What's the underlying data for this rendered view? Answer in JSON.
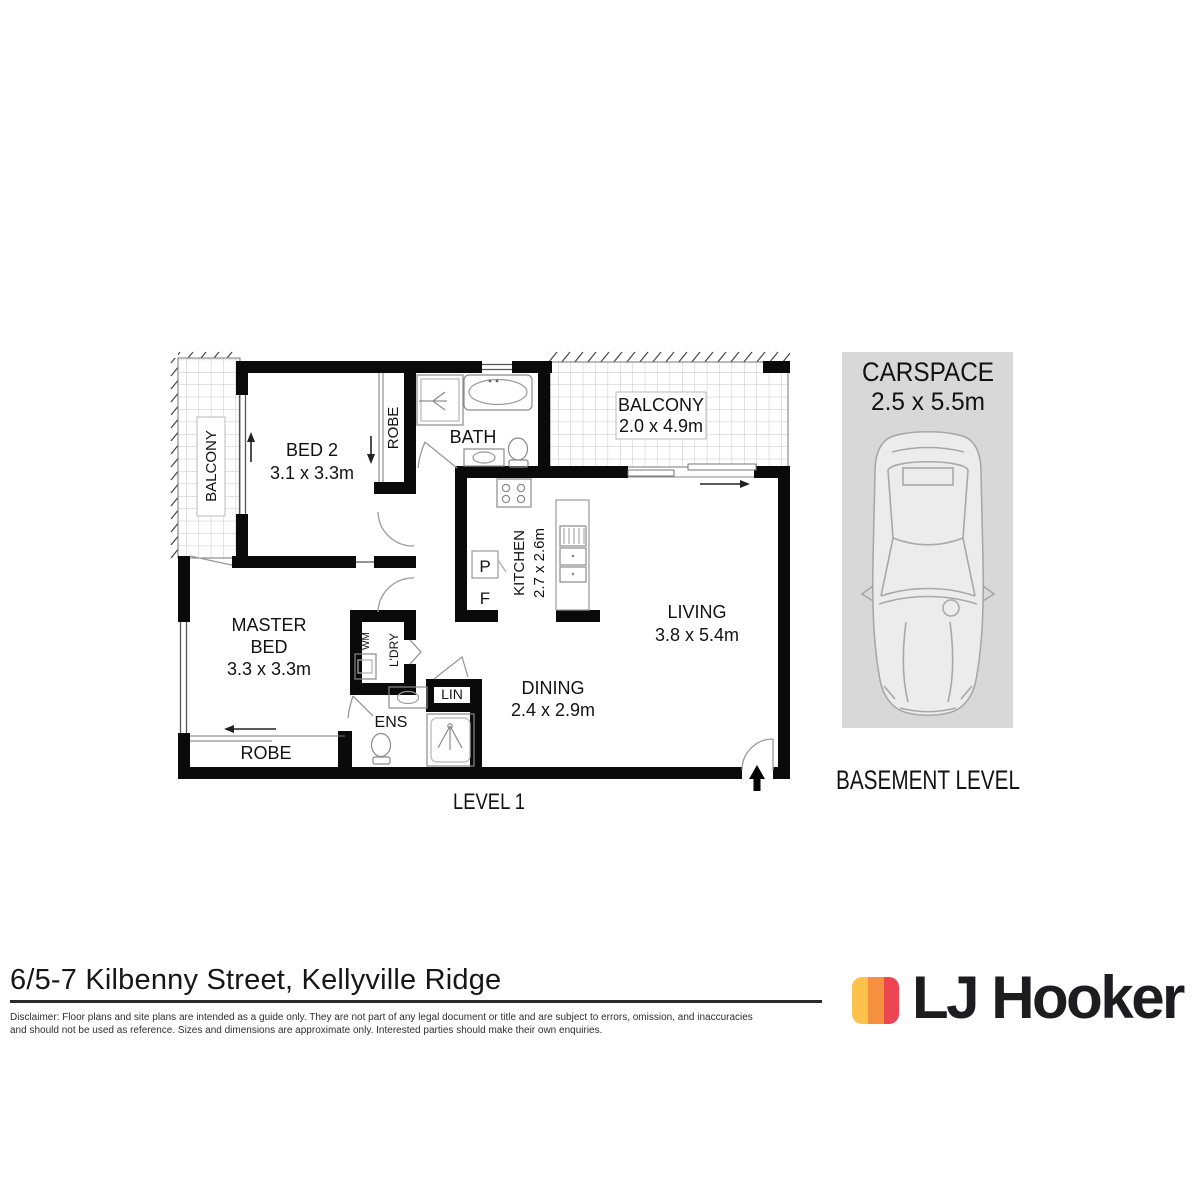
{
  "floorplan": {
    "level_label": "LEVEL 1",
    "labels": {
      "balcony_left": "BALCONY",
      "bed2_name": "BED 2",
      "bed2_dims": "3.1 x 3.3m",
      "robe_bed2": "ROBE",
      "bath": "BATH",
      "balcony_top_name": "BALCONY",
      "balcony_top_dims": "2.0 x 4.9m",
      "kitchen_name": "KITCHEN",
      "kitchen_dims": "2.7 x 2.6m",
      "pantry": "P",
      "fridge": "F",
      "living_name": "LIVING",
      "living_dims": "3.8 x 5.4m",
      "master_line1": "MASTER",
      "master_line2": "BED",
      "master_dims": "3.3 x 3.3m",
      "wm": "WM",
      "laundry": "L'DRY",
      "linen": "LIN",
      "ensuite": "ENS",
      "dining_name": "DINING",
      "dining_dims": "2.4 x 2.9m",
      "robe_master": "ROBE"
    }
  },
  "carspace": {
    "title": "CARSPACE",
    "dims": "2.5 x 5.5m",
    "level_label": "BASEMENT LEVEL",
    "bg_color": "#d8d8d8"
  },
  "footer": {
    "address": "6/5-7 Kilbenny Street, Kellyville Ridge",
    "disclaimer_line1": "Disclaimer: Floor plans and site plans are intended as a guide only. They are not part of any legal document or title and are subject to errors, omission, and inaccuracies",
    "disclaimer_line2": "and should not be used as reference. Sizes and dimensions are approximate only. Interested parties should make their own enquiries.",
    "logo_text": "LJ Hooker",
    "logo_colors": [
      "#FCC24B",
      "#F5913E",
      "#EC4653"
    ]
  }
}
